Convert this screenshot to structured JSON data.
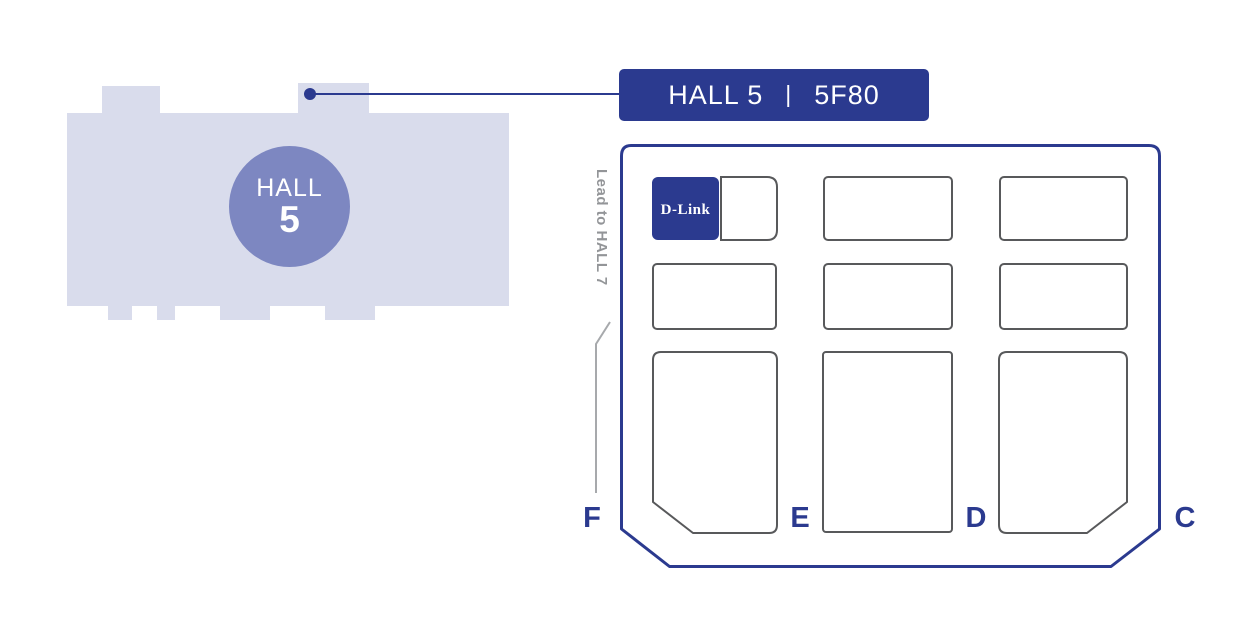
{
  "colors": {
    "primary_blue": "#2b3a8f",
    "hall_silhouette_fill": "#d9dcec",
    "hall_circle_fill": "#7d87c1",
    "booth_border_gray": "#58595b",
    "direction_text_gray": "#939598",
    "arrow_gray": "#a7a9ac"
  },
  "overview_map": {
    "hall_label": "HALL",
    "hall_number": "5"
  },
  "callout": {
    "hall": "HALL 5",
    "separator": "|",
    "booth": "5F80"
  },
  "floor_plan": {
    "direction_label": "Lead to HALL 7",
    "highlight_booth_logo": "D-Link",
    "aisles": {
      "f": "F",
      "e": "E",
      "d": "D",
      "c": "C"
    }
  }
}
